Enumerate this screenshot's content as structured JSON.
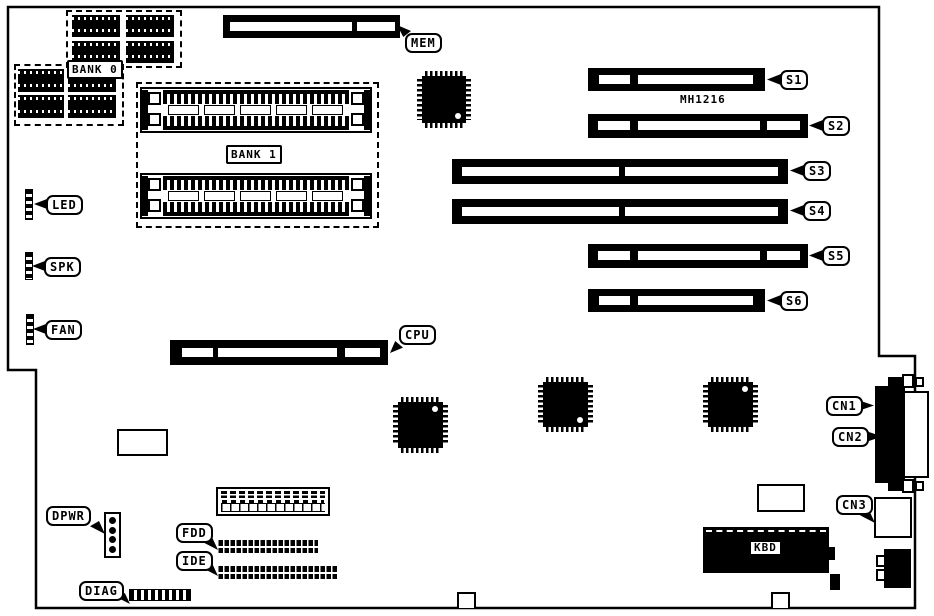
{
  "board": {
    "marking": "MH1216",
    "memory": {
      "mem": "MEM",
      "bank0": "BANK 0",
      "bank1": "BANK 1"
    },
    "slots": {
      "cpu": "CPU",
      "s1": "S1",
      "s2": "S2",
      "s3": "S3",
      "s4": "S4",
      "s5": "S5",
      "s6": "S6"
    },
    "connectors": {
      "led": "LED",
      "spk": "SPK",
      "fan": "FAN",
      "dpwr": "DPWR",
      "diag": "DIAG",
      "fdd": "FDD",
      "ide": "IDE",
      "kbd": "KBD",
      "cn1": "CN1",
      "cn2": "CN2",
      "cn3": "CN3"
    },
    "colors": {
      "ink": "#000000",
      "paper": "#ffffff"
    }
  }
}
